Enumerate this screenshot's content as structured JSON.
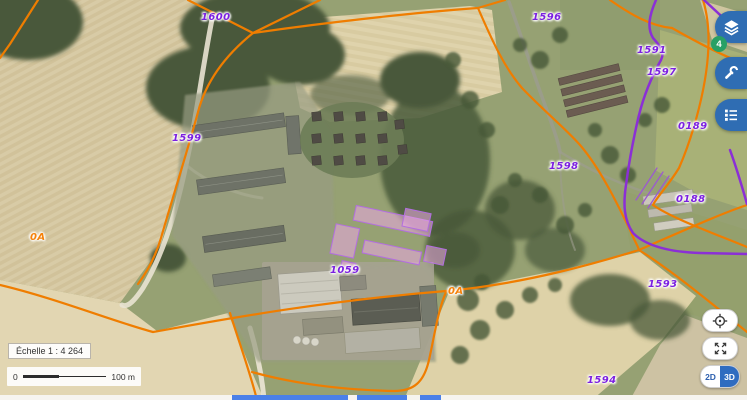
{
  "app": {
    "type": "cadastral-aerial-map-viewer"
  },
  "map": {
    "parcel_labels": [
      {
        "text": "1600"
      },
      {
        "text": "1596"
      },
      {
        "text": "1591"
      },
      {
        "text": "1597"
      },
      {
        "text": "0189"
      },
      {
        "text": "1599"
      },
      {
        "text": "1598"
      },
      {
        "text": "0188"
      },
      {
        "text": "1059"
      },
      {
        "text": "1593"
      },
      {
        "text": "1594"
      }
    ],
    "section_labels": [
      {
        "text": "0A"
      },
      {
        "text": "0A"
      }
    ]
  },
  "right_toolbar": {
    "buttons": [
      {
        "icon": "layers-icon",
        "badge": "4"
      },
      {
        "icon": "wrench-icon"
      },
      {
        "icon": "legend-list-icon"
      }
    ]
  },
  "map_controls": {
    "locate_icon": "crosshair-icon",
    "fullscreen_icon": "expand-icon",
    "view_toggle": {
      "d2": "2D",
      "d3": "3D",
      "active": "3D"
    }
  },
  "scale": {
    "ratio_label": "Échelle 1 : 4 264",
    "bar": {
      "start": "0",
      "end": "100 m"
    }
  },
  "colors": {
    "parcel_line_orange": "#ef7d00",
    "commune_line_purple": "#8b2fd6",
    "parcel_label_purple": "#7b1fe0",
    "section_label_orange": "#f5820a",
    "toolbar_blue": "#2f6db3",
    "badge_green": "#27a065",
    "toggle_blue": "#2f6cc0",
    "bottom_bar_blue": "#4a80e8"
  }
}
